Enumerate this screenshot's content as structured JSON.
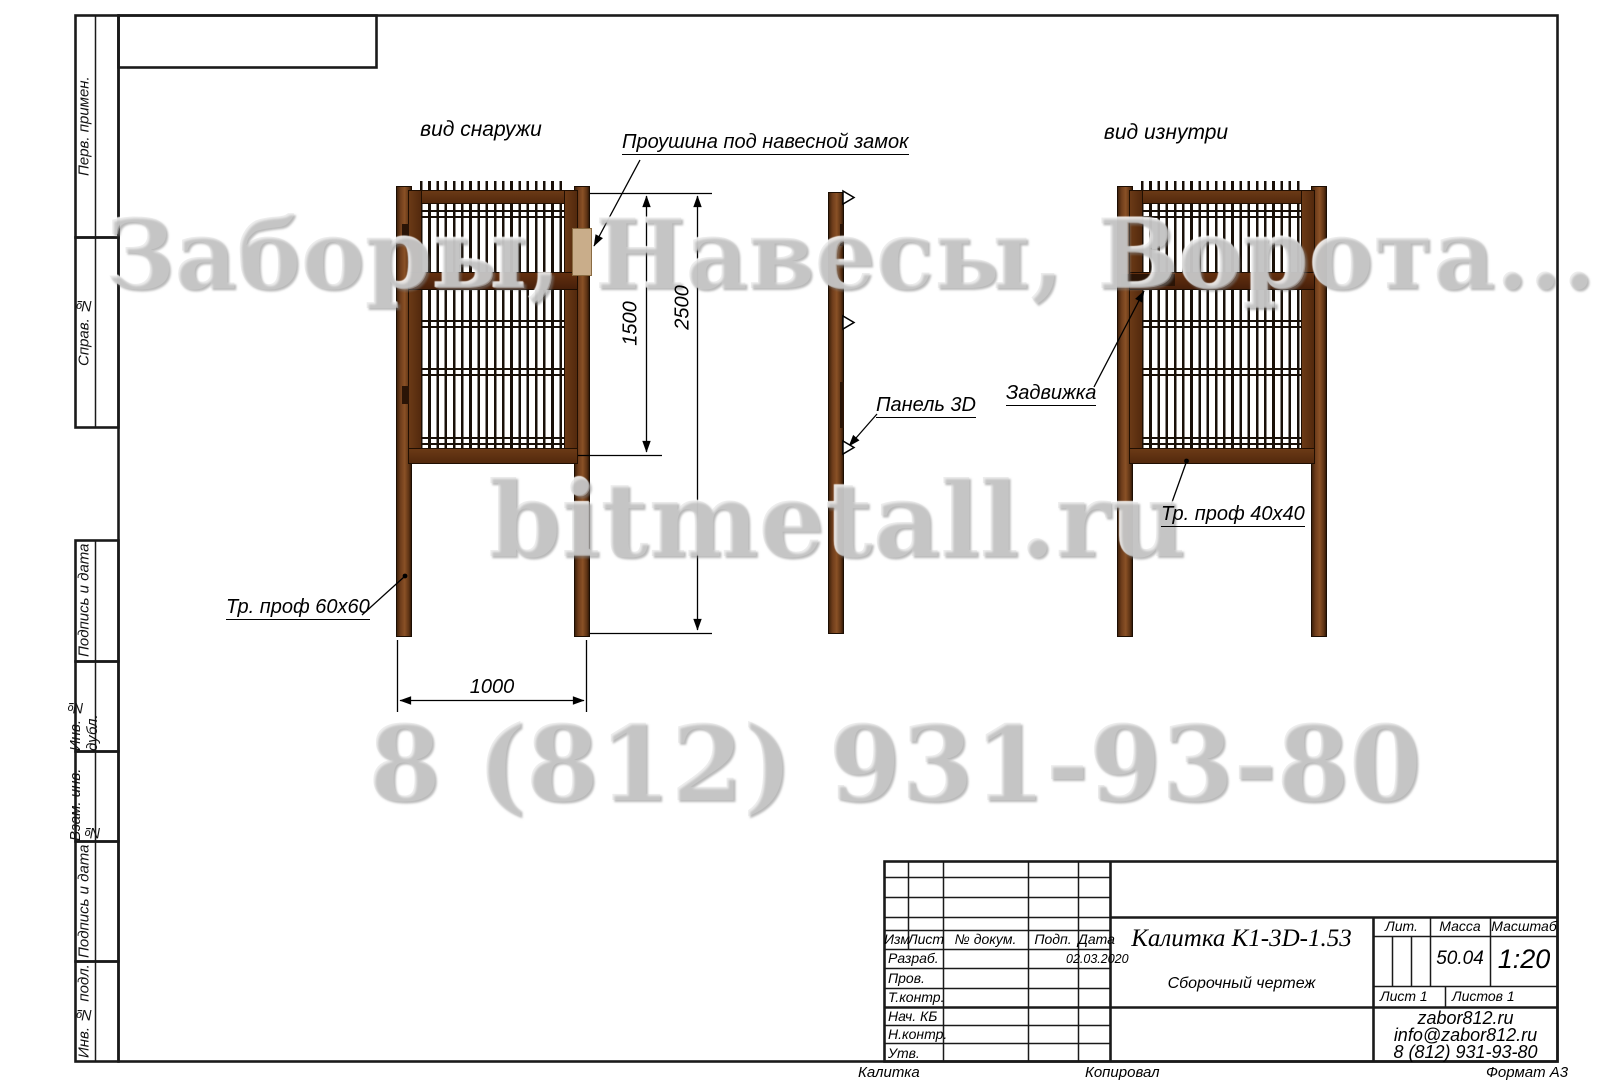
{
  "margin_labels": [
    "Перв. примен.",
    "Справ. №",
    "Подпись и дата",
    "Инв. № дубл.",
    "Взам. инв. №",
    "Подпись и дата",
    "Инв. № подл."
  ],
  "views": {
    "outside_title": "вид снаружи",
    "inside_title": "вид изнутри"
  },
  "annotations": {
    "lock_eye": "Проушина под навесной замок",
    "panel": "Панель 3D",
    "latch": "Задвижка",
    "post_profile": "Тр. проф 60х60",
    "frame_profile": "Тр. проф 40х40"
  },
  "dimensions": {
    "panel_height": "1500",
    "total_height": "2500",
    "width": "1000"
  },
  "watermarks": {
    "line1": "Заборы, Навесы, Ворота...",
    "line2": "bitmetall.ru",
    "line3": "8 (812) 931-93-80"
  },
  "title_block": {
    "doc_title": "Калитка К1-3D-1.53",
    "doc_type": "Сборочный чертеж",
    "header_cells": [
      "Изм",
      "Лист",
      "№ докум.",
      "Подп.",
      "Дата"
    ],
    "rows": [
      "Разраб.",
      "Пров.",
      "Т.контр.",
      "Нач. КБ",
      "Н.контр.",
      "Утв."
    ],
    "date": "02.03.2020",
    "lit_label": "Лит.",
    "mass_label": "Масса",
    "scale_label": "Масштаб",
    "mass_value": "50.04",
    "scale_value": "1:20",
    "sheet_label": "Лист 1",
    "sheets_label": "Листов 1",
    "site": "zabor812.ru",
    "email": "info@zabor812.ru",
    "phone": "8 (812) 931-93-80"
  },
  "footer": {
    "left": "Калитка",
    "center": "Копировал",
    "right": "Формат А3"
  },
  "colors": {
    "post_brown": "#6f3d1b",
    "mesh_dark": "#191008",
    "watermark_gray": "#d6d6d6"
  }
}
